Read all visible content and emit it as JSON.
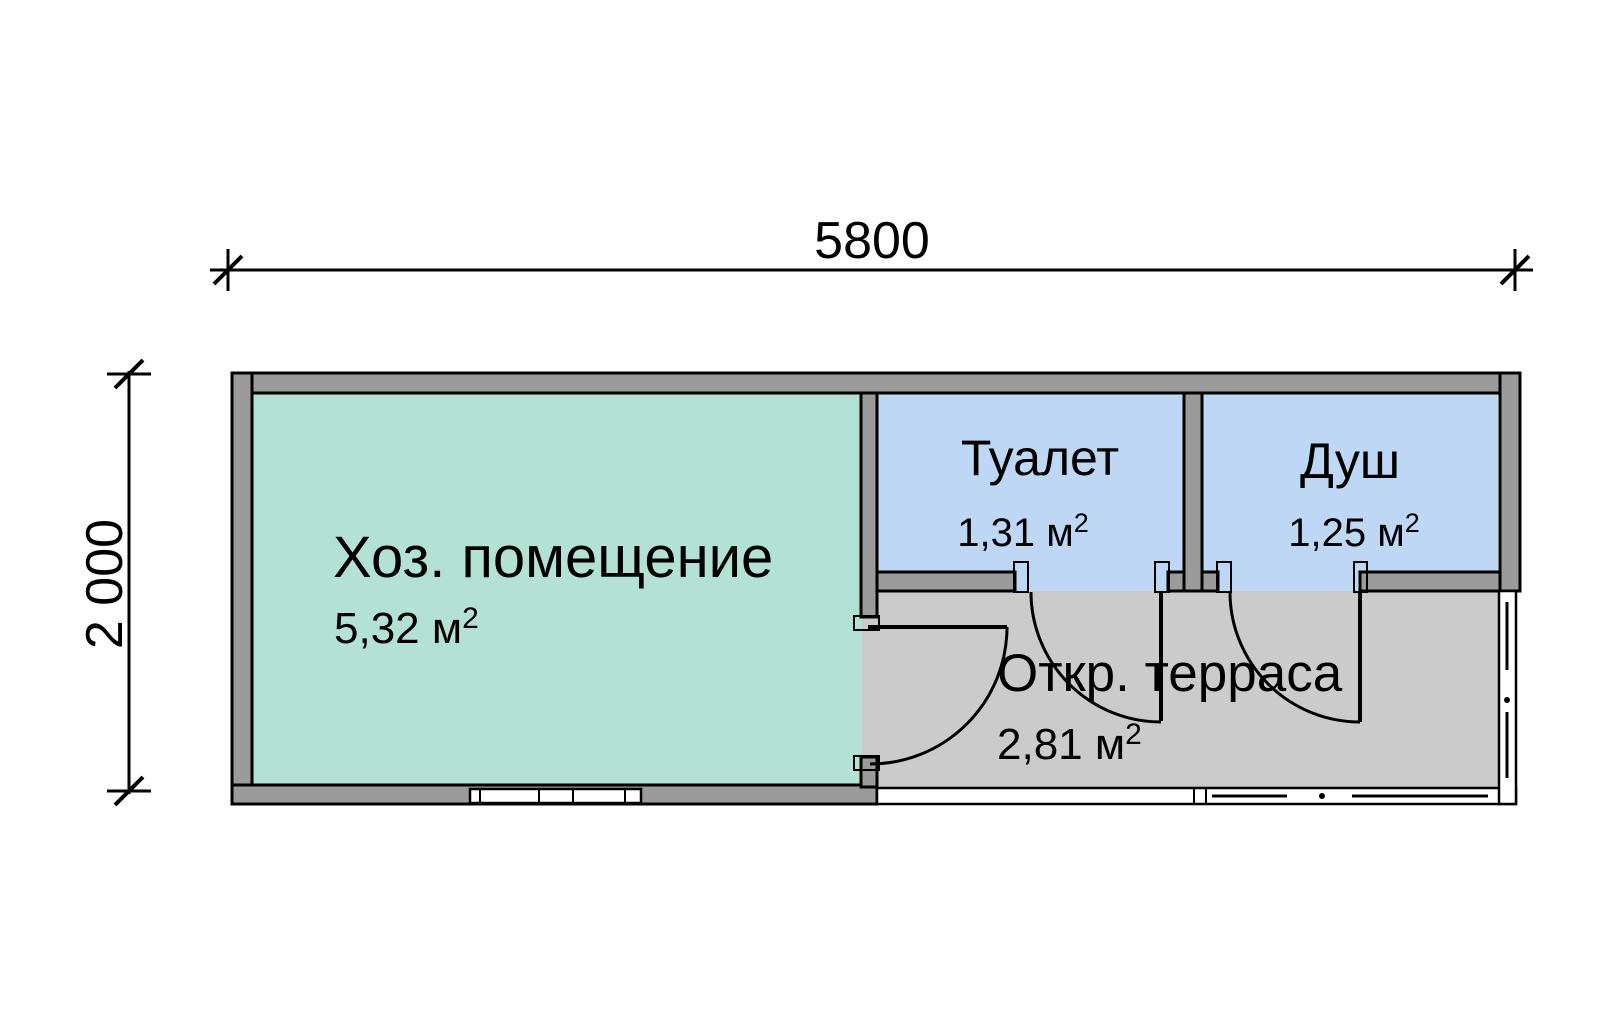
{
  "dimensions": {
    "width_mm": "5800",
    "height_mm": "2 000"
  },
  "rooms": [
    {
      "name": "Хоз. помещение",
      "area": "5,32 м",
      "area_exponent": "2",
      "fill": "#b4e1d6"
    },
    {
      "name": "Туалет",
      "area": "1,31 м",
      "area_exponent": "2",
      "fill": "#bdd7f5"
    },
    {
      "name": "Душ",
      "area": "1,25 м",
      "area_exponent": "2",
      "fill": "#bdd7f5"
    },
    {
      "name": "Откр. терраса",
      "area": "2,81 м",
      "area_exponent": "2",
      "fill": "#cbcbcb"
    }
  ],
  "colors": {
    "wall": "#9b9b9b",
    "outline": "#000000",
    "door_jamb": "#ffffff",
    "background": "#ffffff"
  }
}
